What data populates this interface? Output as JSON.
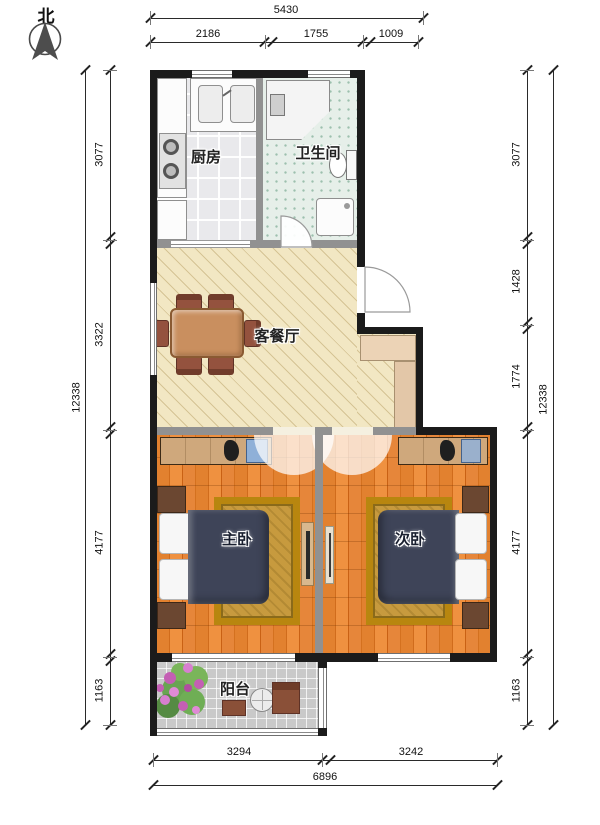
{
  "compass": {
    "label": "北"
  },
  "rooms": {
    "kitchen": "厨房",
    "bathroom": "卫生间",
    "living_dining": "客餐厅",
    "master_bedroom": "主卧",
    "second_bedroom": "次卧",
    "balcony": "阳台"
  },
  "dimensions": {
    "top": {
      "overall": "5430",
      "segments": [
        "2186",
        "1755",
        "1009"
      ]
    },
    "left": {
      "overall": "12338",
      "segments": [
        "3077",
        "3322",
        "4177",
        "1163"
      ]
    },
    "right": {
      "overall": "12338",
      "segments": [
        "3077",
        "1428",
        "1774",
        "4177",
        "1163"
      ]
    },
    "bottom": {
      "overall": "6896",
      "segments": [
        "3294",
        "3242"
      ]
    }
  },
  "icons": {
    "compass_arrow": "north-arrow",
    "plant": "flower-plant",
    "shirts": "hanging-clothes"
  },
  "colors": {
    "wall": "#1b1b1b",
    "interior_wall": "#919191",
    "living_floor": "#f2e7c3",
    "bedroom_floor": "#e2812f",
    "bathroom_floor": "#e6efe9",
    "kitchen_floor": "#e9e9ec",
    "balcony_floor": "#c9c9c9",
    "bed": "#3e4458",
    "rug": "#c79a3e",
    "wardrobe": "#cfa87c",
    "dining_table": "#c98f5f",
    "chair": "#94523e",
    "flowers": "#c45fb4",
    "leaves": "#69a452"
  }
}
